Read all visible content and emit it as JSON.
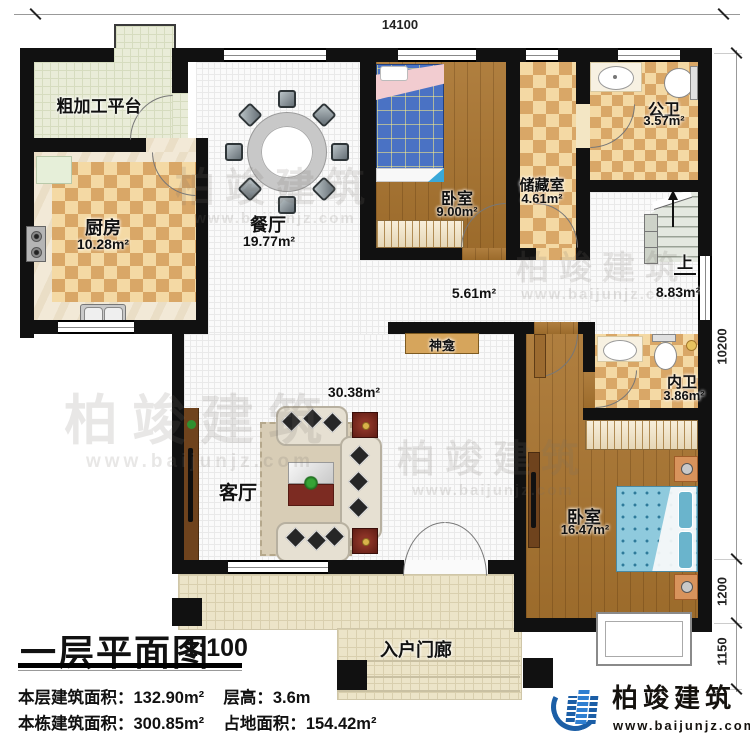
{
  "dimensions": {
    "top": "14100",
    "right_total": "10200",
    "right_upper": "1200",
    "right_lower": "1150"
  },
  "rooms": {
    "platform": {
      "name": "粗加工平台"
    },
    "kitchen": {
      "name": "厨房",
      "area": "10.28m²"
    },
    "dining": {
      "name": "餐厅",
      "area": "19.77m²"
    },
    "bedroom_small": {
      "name": "卧室",
      "area": "9.00m²"
    },
    "storage": {
      "name": "储藏室",
      "area": "4.61m²"
    },
    "public_bath": {
      "name": "公卫",
      "area": "3.57m²"
    },
    "stair_hall": {
      "up_label": "上",
      "area": "8.83m²"
    },
    "corridor": {
      "area": "5.61m²"
    },
    "shrine": {
      "name": "神龛"
    },
    "living": {
      "name": "客厅",
      "area": "30.38m²"
    },
    "inner_bath": {
      "name": "内卫",
      "area": "3.86m²"
    },
    "bedroom_master": {
      "name": "卧室",
      "area": "16.47m²"
    },
    "porch": {
      "name": "入户门廊"
    }
  },
  "title_block": {
    "title": "一层平面图",
    "scale": "1:100",
    "stats": [
      {
        "label": "本层建筑面积：",
        "value": "132.90m²"
      },
      {
        "label": "层高：",
        "value": "3.6m"
      },
      {
        "label": "本栋建筑面积：",
        "value": "300.85m²"
      },
      {
        "label": "占地面积：",
        "value": "154.42m²"
      }
    ]
  },
  "branding": {
    "company": "柏竣建筑",
    "website": "www.baijunjz.com"
  },
  "palette": {
    "wall": "#111111",
    "checker_light": "#f4d9a4",
    "checker_dark": "#d9a767",
    "wood": "#a9742f",
    "tile_platform": "#e9ecd8",
    "tile_porch": "#ece4c8",
    "logo_blue": "#1b5ea6",
    "text_dark": "#15120e"
  }
}
